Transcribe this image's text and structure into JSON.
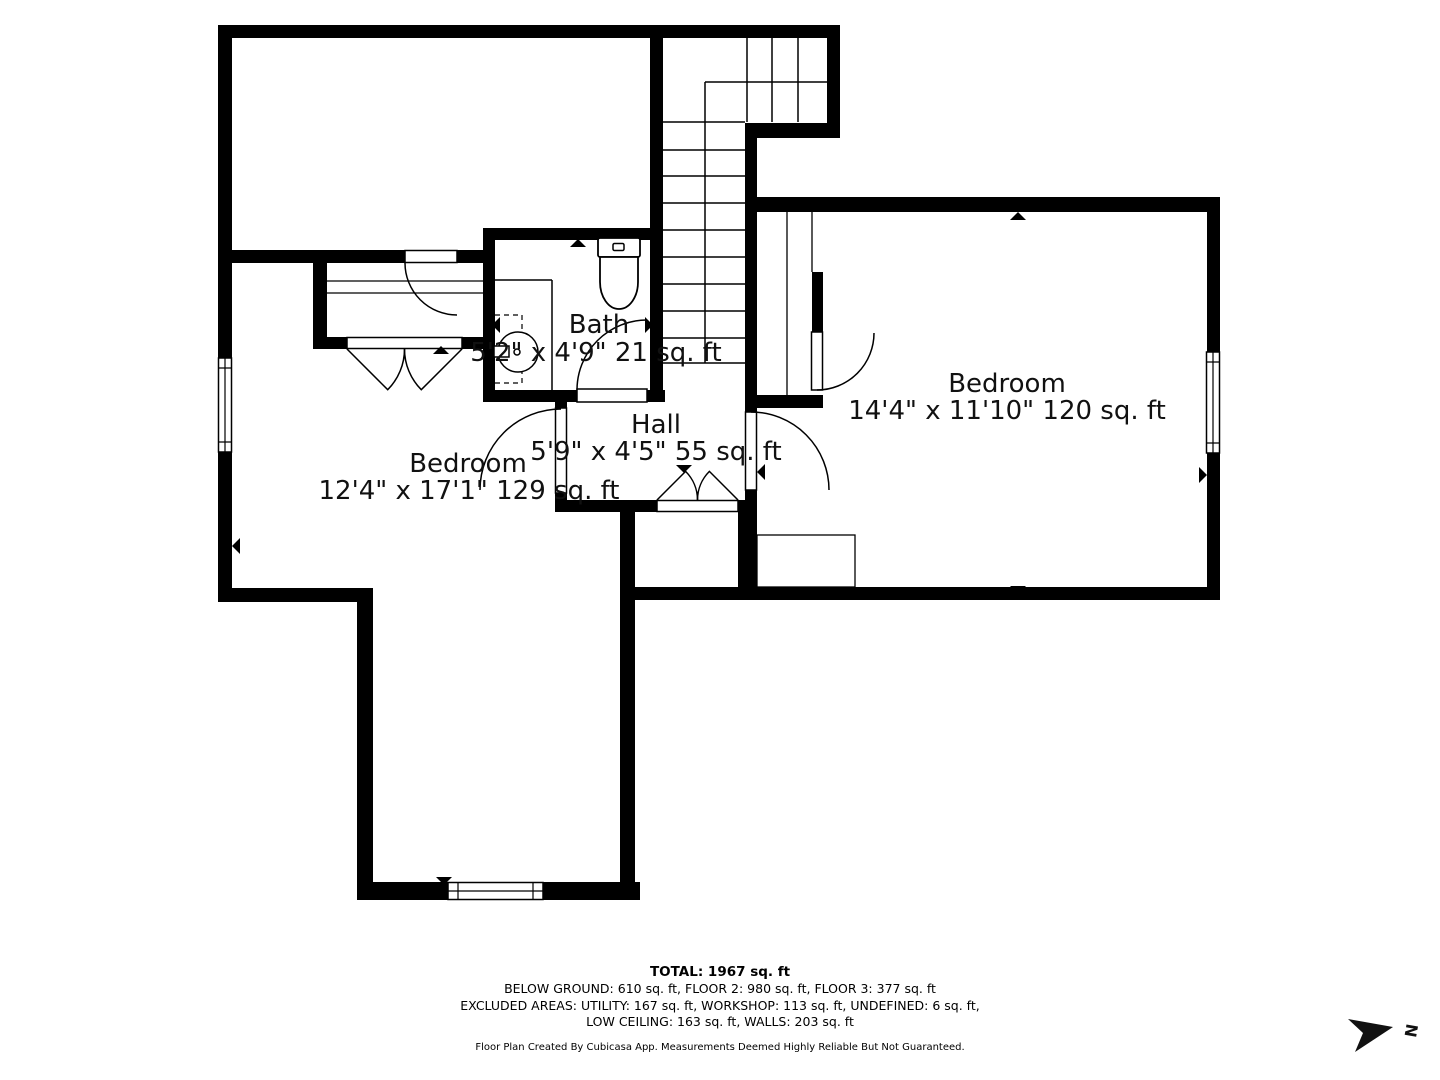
{
  "rooms": {
    "bath": {
      "name": "Bath",
      "dims": "5'2\" x 4'9\" 21 sq. ft"
    },
    "hall": {
      "name": "Hall",
      "dims": "5'9\" x 4'5\" 55 sq. ft"
    },
    "bedroom_left": {
      "name": "Bedroom",
      "dims": "12'4\" x 17'1\" 129 sq. ft"
    },
    "bedroom_right": {
      "name": "Bedroom",
      "dims": "14'4\" x 11'10\" 120 sq. ft"
    }
  },
  "footer": {
    "total": "TOTAL: 1967 sq. ft",
    "line1": "BELOW GROUND: 610 sq. ft, FLOOR 2: 980 sq. ft, FLOOR 3: 377 sq. ft",
    "line2": "EXCLUDED AREAS: UTILITY: 167 sq. ft, WORKSHOP: 113 sq. ft, UNDEFINED: 6 sq. ft,",
    "line3": "LOW CEILING: 163 sq. ft, WALLS: 203 sq. ft",
    "disclaimer": "Floor Plan Created By Cubicasa App. Measurements Deemed Highly Reliable But Not Guaranteed."
  },
  "compass": {
    "label": "N"
  },
  "colors": {
    "walls": "#000000",
    "background": "#ffffff",
    "text": "#111111"
  }
}
